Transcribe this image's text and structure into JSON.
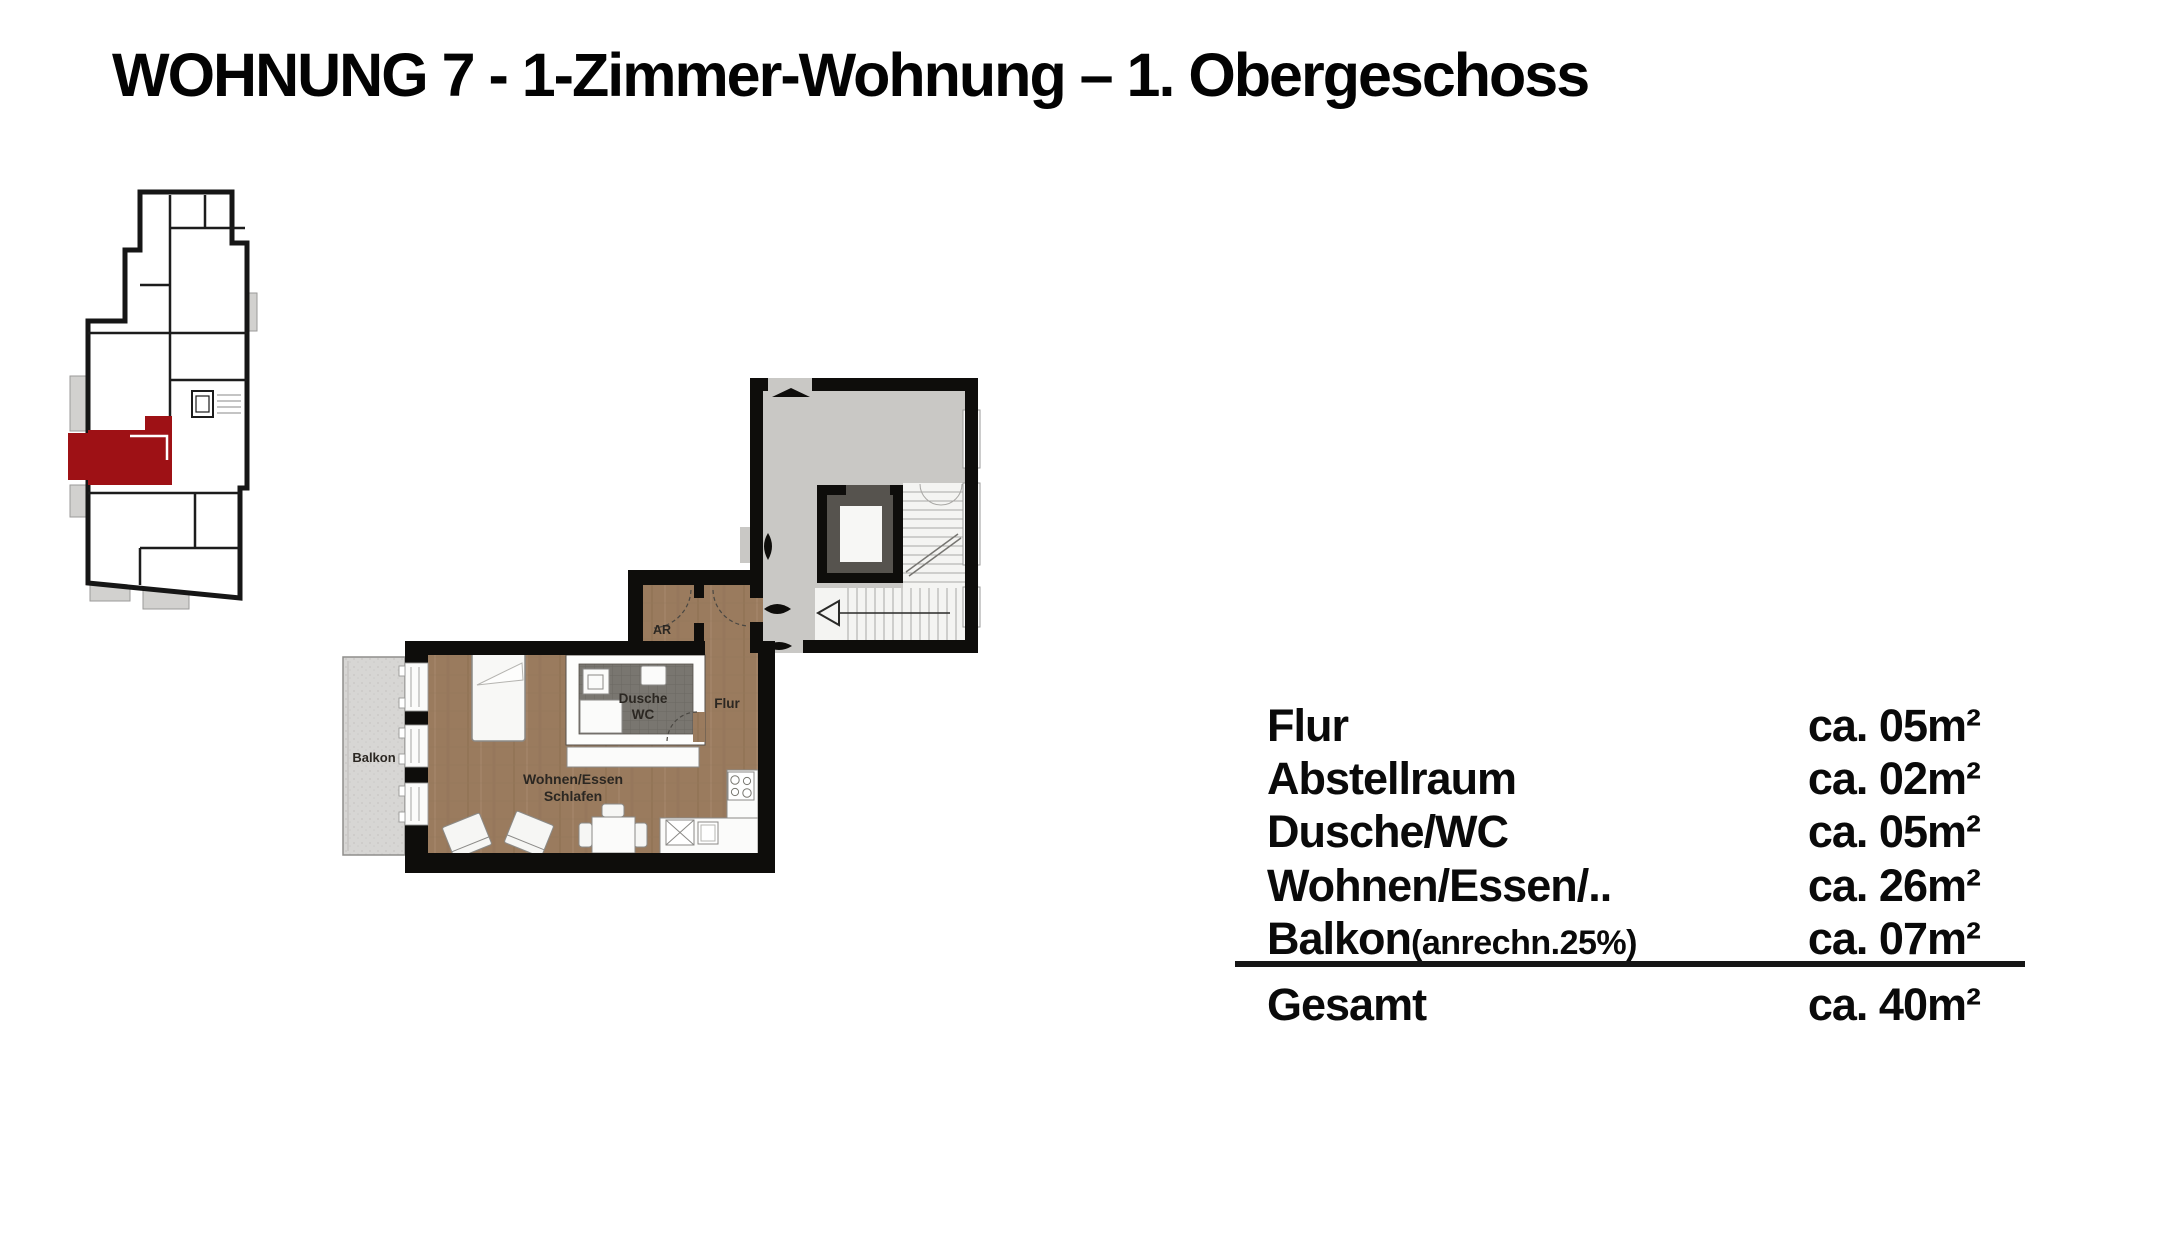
{
  "title": "WOHNUNG 7 - 1-Zimmer-Wohnung – 1. Obergeschoss",
  "overview_plan": {
    "description": "small building floor overview with unit 7 highlighted in red",
    "highlight_color": "#9e1115"
  },
  "floor_plan": {
    "labels": {
      "balkon": "Balkon",
      "ar": "AR",
      "flur": "Flur",
      "dusche": "Dusche",
      "wc": "WC",
      "wohnen_essen": "Wohnen/Essen",
      "schlafen": "Schlafen"
    }
  },
  "area_table": {
    "rows": [
      {
        "label": "Flur",
        "note": "",
        "value": "ca. 05m²"
      },
      {
        "label": "Abstellraum",
        "note": "",
        "value": "ca. 02m²"
      },
      {
        "label": "Dusche/WC",
        "note": "",
        "value": "ca. 05m²"
      },
      {
        "label": "Wohnen/Essen/..",
        "note": "",
        "value": "ca. 26m²"
      },
      {
        "label": "Balkon",
        "note": "(anrechn.25%)",
        "value": "ca. 07m²"
      }
    ],
    "total": {
      "label": "Gesamt",
      "value": "ca. 40m²"
    }
  },
  "colors": {
    "wall_black": "#0e0d0b",
    "apartment_floor_brown": "#9a7b5e",
    "stairwell_gray": "#c9c8c5",
    "elevator_dark_gray": "#56534e",
    "shower_tile_gray": "#797670",
    "balcony_gray": "#d7d6d4",
    "highlight_red": "#9e1115",
    "text_black": "#0a0a0a"
  }
}
